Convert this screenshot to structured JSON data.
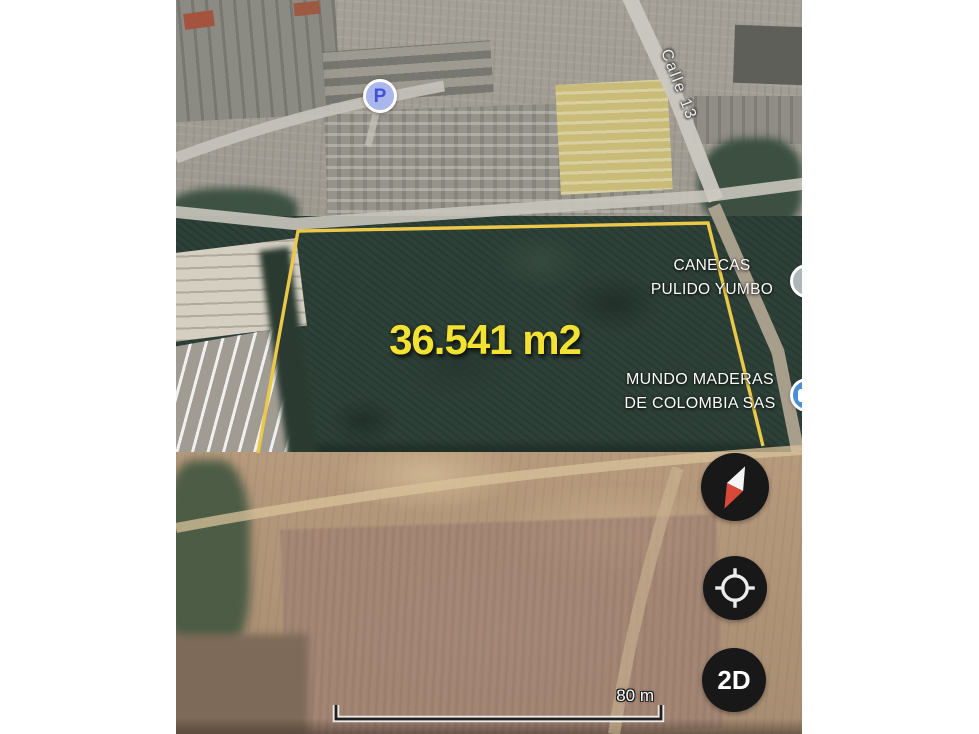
{
  "map": {
    "street_label": "Calle 13",
    "parking_label": "P",
    "area_label": "36.541 m2",
    "poi_canecas_line1": "CANECAS",
    "poi_canecas_line2": "PULIDO YUMBO",
    "poi_mundo_line1": "MUNDO MADERAS",
    "poi_mundo_line2": "DE COLOMBIA SAS"
  },
  "controls": {
    "view_toggle_label": "2D"
  },
  "scale_bar": {
    "label": "80 m"
  },
  "colors": {
    "boundary": "#ecc848",
    "area_text": "#f4e233",
    "parking_fill": "#aab6ee",
    "parking_letter": "#3f51d6",
    "marker_blue": "#4a8fd4",
    "marker_gray": "#aeb6ba",
    "control_bg": "#181818",
    "compass_needle_red": "#d8493a",
    "compass_needle_white": "#f5f5f5"
  },
  "icons": {
    "compass": "compass-needle",
    "my_location": "crosshair-target",
    "parking": "letter-p-badge",
    "view_toggle": "text-2d"
  }
}
